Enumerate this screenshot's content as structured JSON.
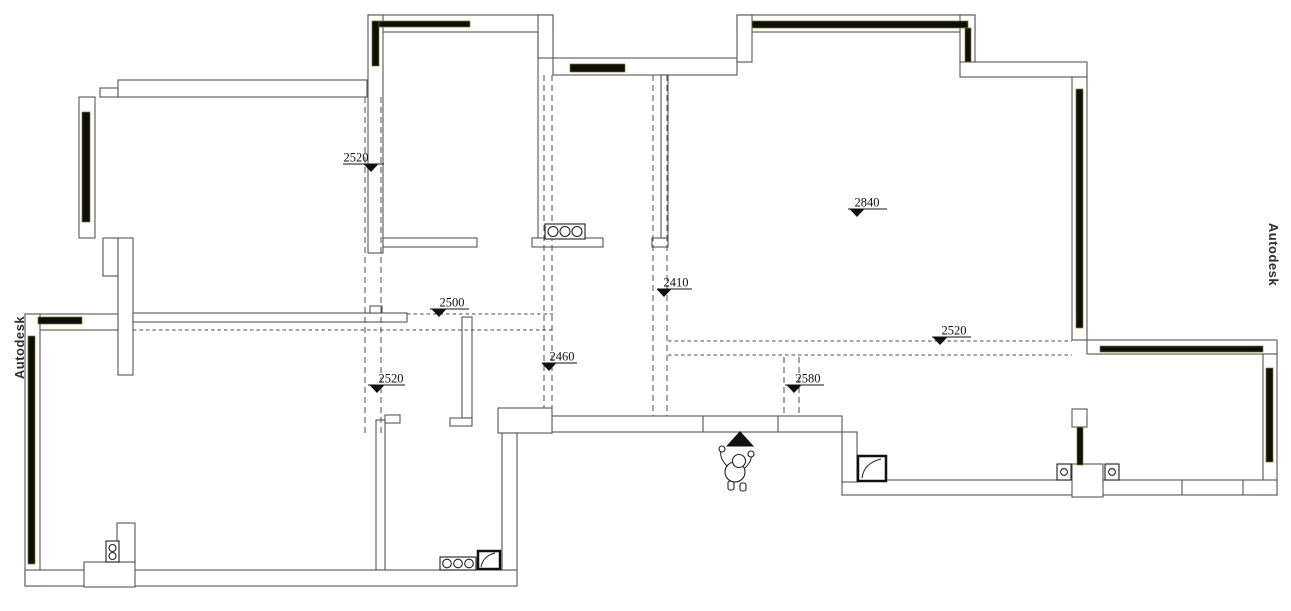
{
  "drawing": {
    "type": "floor-plan-ceiling-height-diagram",
    "watermark_left": "Autodesk",
    "watermark_right": "Autodesk",
    "wall_color": "#565656",
    "window_color": "#0d0d0d",
    "marker_color": "#111111"
  },
  "elevation_markers": [
    {
      "id": "m-top-left-room",
      "value": "2520",
      "text_x": 356,
      "line_y": 164,
      "line_x1": 343,
      "line_x2": 384,
      "tri_x": 371
    },
    {
      "id": "m-living-room",
      "value": "2840",
      "text_x": 867,
      "line_y": 209,
      "line_x1": 848,
      "line_x2": 887,
      "tri_x": 857
    },
    {
      "id": "m-hallway",
      "value": "2410",
      "text_x": 676,
      "line_y": 289,
      "line_x1": 657,
      "line_x2": 692,
      "tri_x": 664
    },
    {
      "id": "m-kitchen-passage",
      "value": "2500",
      "text_x": 452,
      "line_y": 309,
      "line_x1": 430,
      "line_x2": 469,
      "tri_x": 439
    },
    {
      "id": "m-corridor",
      "value": "2460",
      "text_x": 562,
      "line_y": 363,
      "line_x1": 542,
      "line_x2": 577,
      "tri_x": 549
    },
    {
      "id": "m-dining-area",
      "value": "2520",
      "text_x": 391,
      "line_y": 385,
      "line_x1": 368,
      "line_x2": 405,
      "tri_x": 377
    },
    {
      "id": "m-entry",
      "value": "2580",
      "text_x": 808,
      "line_y": 385,
      "line_x1": 785,
      "line_x2": 824,
      "tri_x": 794
    },
    {
      "id": "m-living-room-south",
      "value": "2520",
      "text_x": 954,
      "line_y": 337,
      "line_x1": 932,
      "line_x2": 971,
      "tri_x": 940
    }
  ],
  "symbols": {
    "entry_arrow": "filled-triangle-up",
    "person_figure": "person-top-view",
    "hob_3_burner_x2": "three-circles-in-box",
    "double_socket": "two-circles-in-box",
    "single_socket_x2": "circle-in-box",
    "floor_drain_x2": "square-with-diagonal"
  }
}
